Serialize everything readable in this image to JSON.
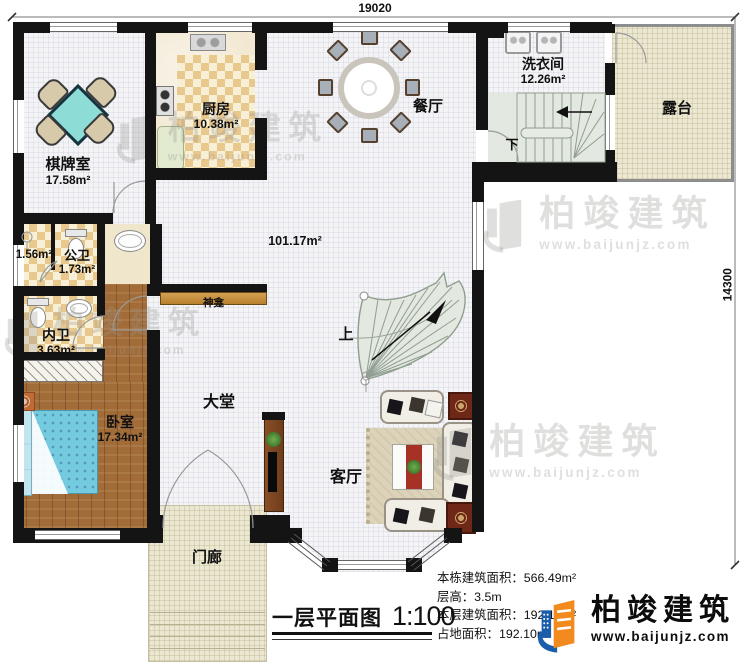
{
  "dimensions": {
    "top": "19020",
    "right": "14300"
  },
  "rooms": {
    "chess": {
      "name": "棋牌室",
      "area": "17.58m²"
    },
    "kitchen": {
      "name": "厨房",
      "area": "10.38m²"
    },
    "dining": {
      "name": "餐厅"
    },
    "laundry": {
      "name": "洗衣间",
      "area": "12.26m²"
    },
    "terrace": {
      "name": "露台"
    },
    "storage": {
      "area": "1.56m²"
    },
    "public_bath": {
      "name": "公卫",
      "area": "1.73m²"
    },
    "inner_bath": {
      "name": "内卫",
      "area": "3.63m²"
    },
    "bedroom": {
      "name": "卧室",
      "area": "17.34m²"
    },
    "hall": {
      "name": "大堂",
      "area": "101.17m²"
    },
    "living": {
      "name": "客厅"
    },
    "porch": {
      "name": "门廊"
    },
    "shrine": {
      "name": "神龛"
    }
  },
  "stairs": {
    "up": "上",
    "down": "下"
  },
  "titleblock": {
    "title": "一层平面图",
    "scale": "1:100"
  },
  "stats": [
    {
      "label": "本栋建筑面积：",
      "value": "566.49m²"
    },
    {
      "label": "层高：",
      "value": "3.5m"
    },
    {
      "label": "本层建筑面积：",
      "value": "192.10m²"
    },
    {
      "label": "占地面积：",
      "value": "192.10m²"
    }
  ],
  "brand": {
    "name": "柏竣建筑",
    "url": "www.baijunjz.com"
  },
  "watermark": {
    "name": "柏竣建筑",
    "url": "www.baijunjz.com"
  },
  "colors": {
    "accent_blue": "#1a5dab",
    "accent_orange": "#f28a1d",
    "wall": "#141414"
  }
}
